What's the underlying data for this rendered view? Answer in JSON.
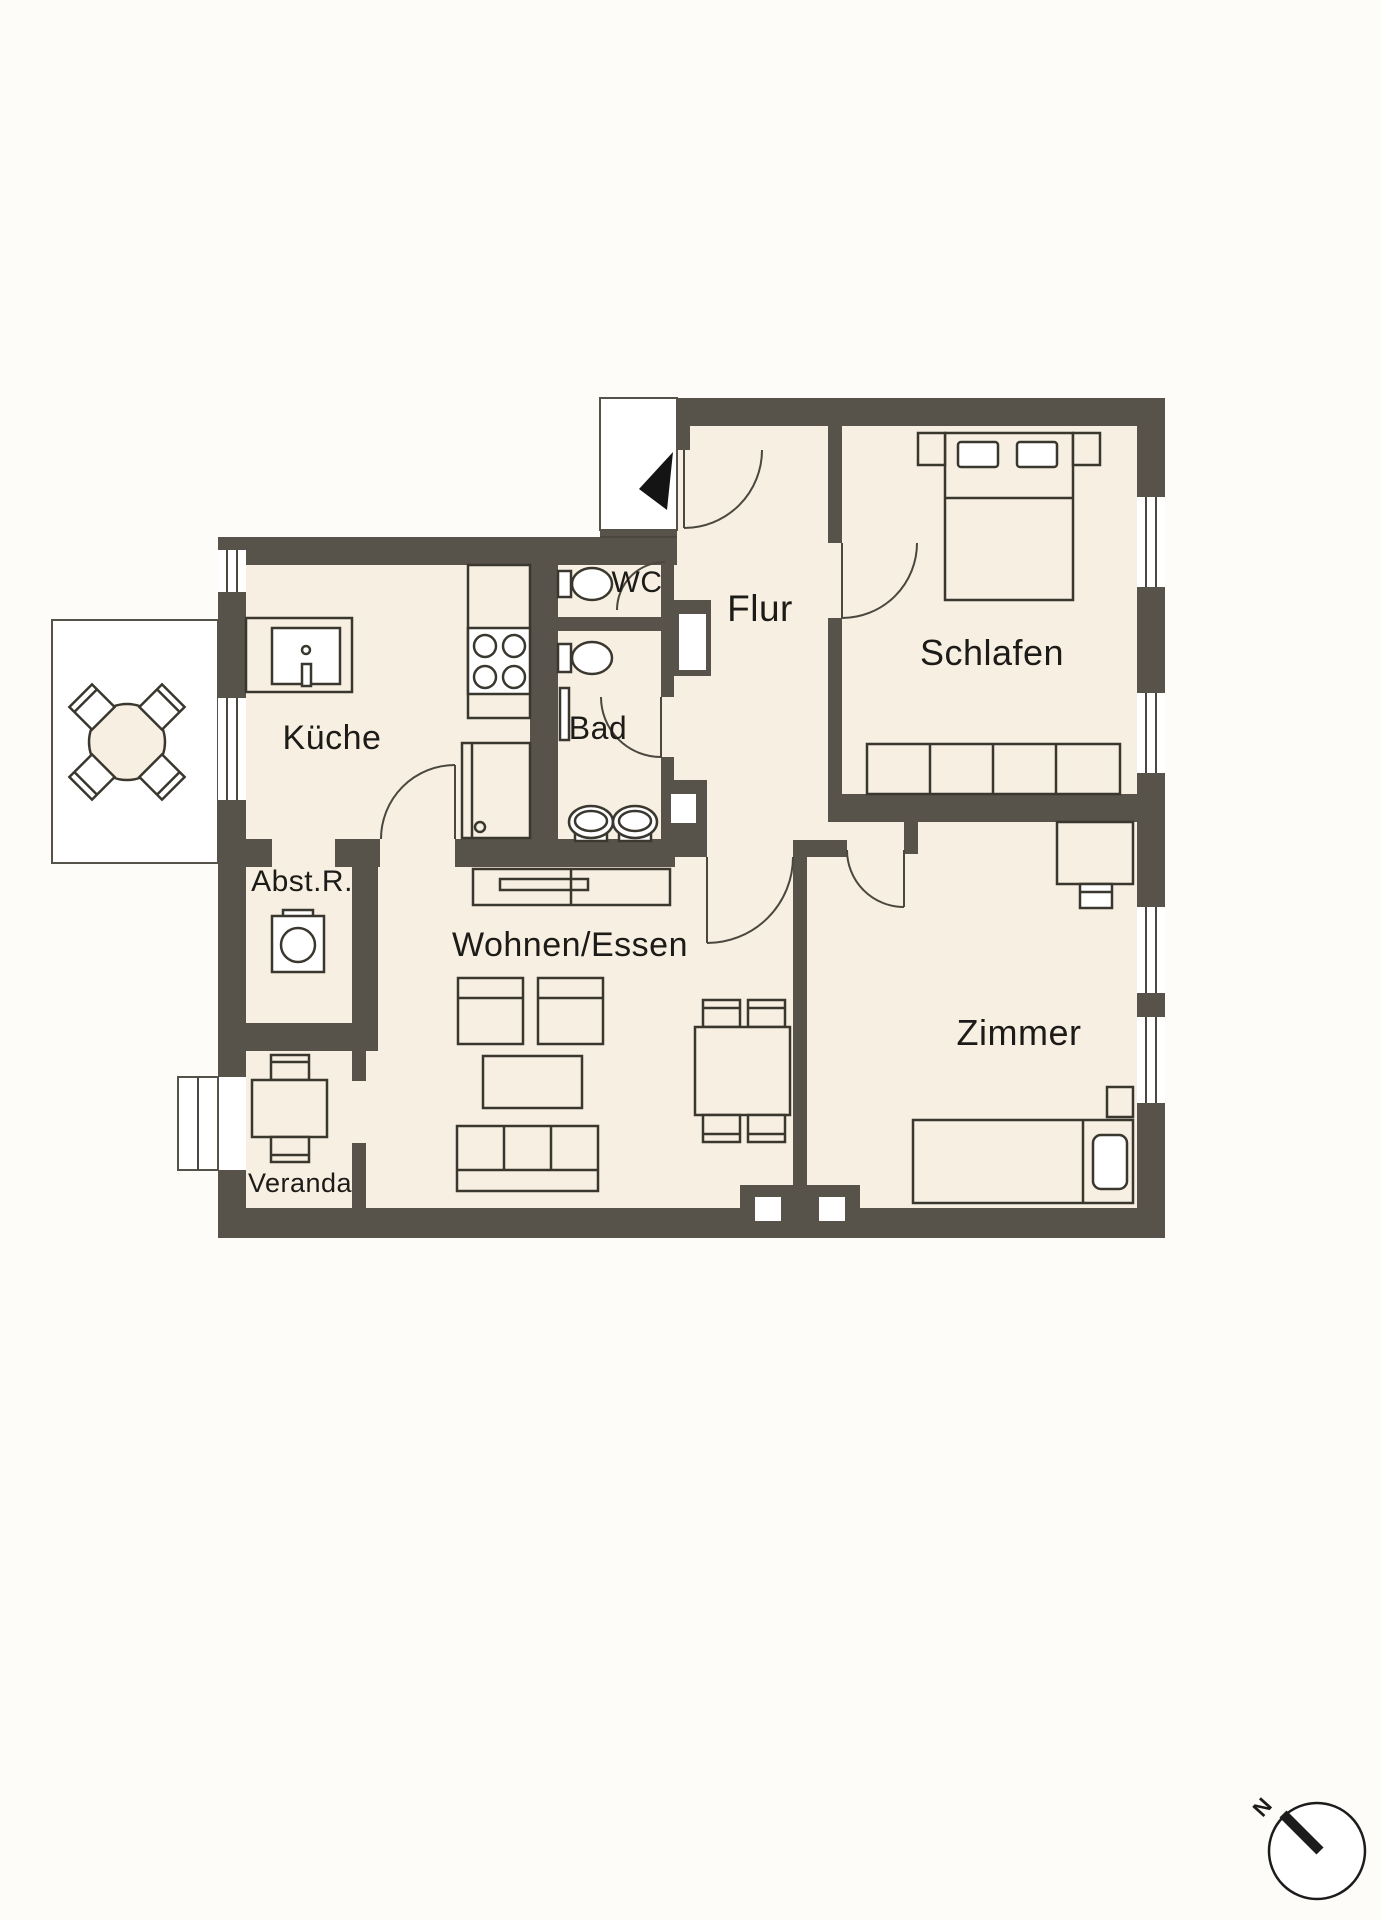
{
  "plan": {
    "type": "apartment-floor-plan",
    "rooms": {
      "kueche": "Küche",
      "wc": "WC",
      "flur": "Flur",
      "schlafen": "Schlafen",
      "bad": "Bad",
      "abstellraum": "Abst.R.",
      "wohnen_essen": "Wohnen/Essen",
      "zimmer": "Zimmer",
      "veranda": "Veranda"
    },
    "compass": {
      "north_label": "N"
    },
    "colors": {
      "wall": "#57534a",
      "floor": "#f6efe2",
      "background": "#fdfcf9",
      "furniture_line": "#3a372e",
      "arrow": "#141414"
    }
  }
}
